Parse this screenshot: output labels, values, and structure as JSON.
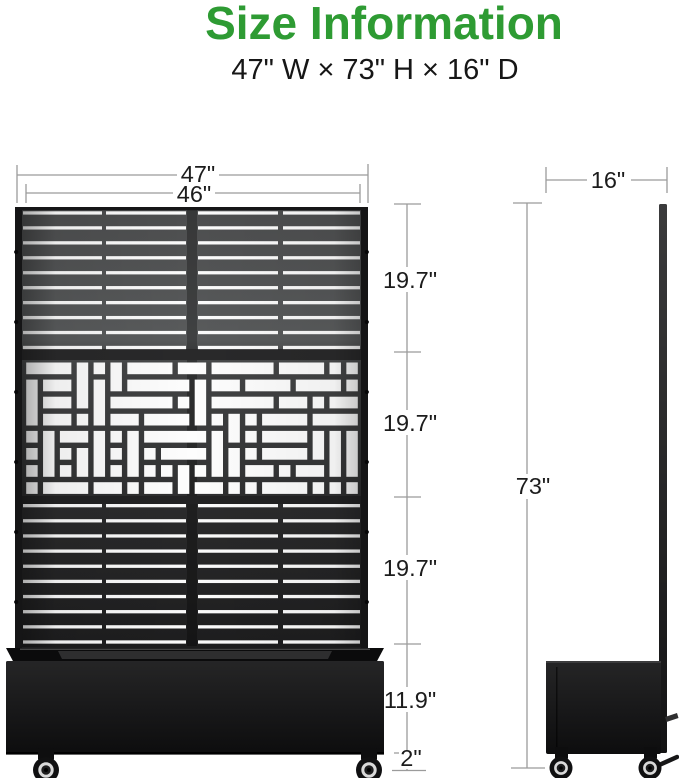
{
  "title": "Size Information",
  "subtitle": "47\" W × 73\" H × 16\" D",
  "colors": {
    "accent": "#2E9B33",
    "dimension_line": "#9B9B9B",
    "label_text": "#1C1C1C",
    "product": "#1B1B1C"
  },
  "front_view": {
    "labels": {
      "outer_width": "47\"",
      "panel_width": "46\"",
      "top_section_height": "19.7\"",
      "middle_section_height": "19.7\"",
      "bottom_section_height": "19.7\"",
      "planter_height": "11.9\"",
      "wheel_clearance": "2\""
    }
  },
  "side_view": {
    "labels": {
      "depth": "16\"",
      "overall_height": "73\""
    }
  }
}
